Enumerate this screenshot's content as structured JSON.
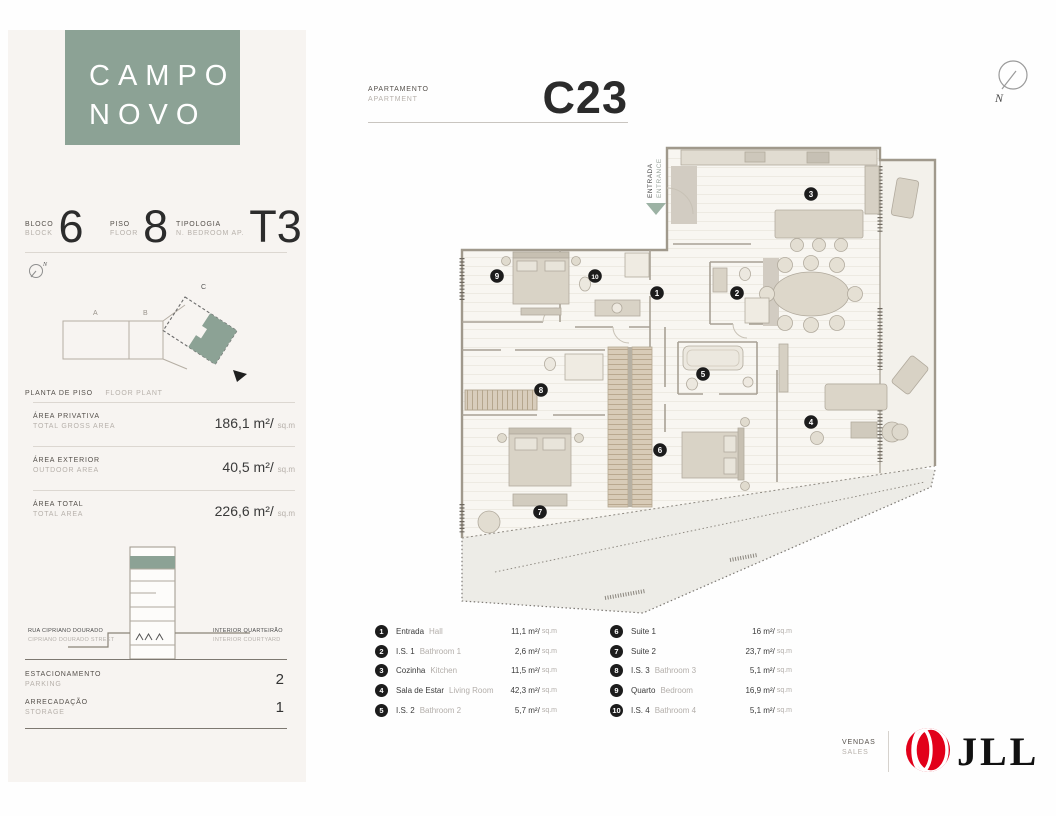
{
  "brand": {
    "name_line1": "CAMPO",
    "name_line2": "NOVO"
  },
  "header": {
    "label_pt": "APARTAMENTO",
    "label_en": "APARTMENT",
    "unit": "C23"
  },
  "compass": {
    "north_label": "N"
  },
  "sidebar": {
    "facts": [
      {
        "label_pt": "BLOCO",
        "label_en": "BLOCK",
        "value": "6"
      },
      {
        "label_pt": "PISO",
        "label_en": "FLOOR",
        "value": "8"
      },
      {
        "label_pt": "TIPOLOGIA",
        "label_en": "N. BEDROOM AP.",
        "value": "T3"
      }
    ],
    "site_plan": {
      "title_pt": "PLANTA DE PISO",
      "title_en": "FLOOR PLANT",
      "block_labels": [
        "A",
        "B",
        "C"
      ]
    },
    "areas": [
      {
        "label_pt": "ÁREA PRIVATIVA",
        "label_en": "TOTAL GROSS AREA",
        "value": "186,1 m²/",
        "unit": "sq.m"
      },
      {
        "label_pt": "ÁREA EXTERIOR",
        "label_en": "OUTDOOR AREA",
        "value": "40,5 m²/",
        "unit": "sq.m"
      },
      {
        "label_pt": "ÁREA TOTAL",
        "label_en": "TOTAL AREA",
        "value": "226,6 m²/",
        "unit": "sq.m"
      }
    ],
    "elevation": {
      "left_line1": "RUA CIPRIANO DOURADO",
      "left_line2": "CIPRIANO DOURADO STREET",
      "right_line1": "INTERIOR QUARTEIRÃO",
      "right_line2": "INTERIOR COURTYARD"
    },
    "amenities": [
      {
        "label_pt": "ESTACIONAMENTO",
        "label_en": "PARKING",
        "value": "2"
      },
      {
        "label_pt": "ARRECADAÇÃO",
        "label_en": "STORAGE",
        "value": "1"
      }
    ]
  },
  "plan": {
    "entrance_pt": "ENTRADA",
    "entrance_en": "ENTRANCE"
  },
  "legend": [
    {
      "num": "1",
      "name_pt": "Entrada",
      "name_en": "Hall",
      "value": "11,1 m²/",
      "unit": "sq.m"
    },
    {
      "num": "2",
      "name_pt": "I.S. 1",
      "name_en": "Bathroom 1",
      "value": "2,6 m²/",
      "unit": "sq.m"
    },
    {
      "num": "3",
      "name_pt": "Cozinha",
      "name_en": "Kitchen",
      "value": "11,5 m²/",
      "unit": "sq.m"
    },
    {
      "num": "4",
      "name_pt": "Sala de Estar",
      "name_en": "Living Room",
      "value": "42,3 m²/",
      "unit": "sq.m"
    },
    {
      "num": "5",
      "name_pt": "I.S. 2",
      "name_en": "Bathroom 2",
      "value": "5,7 m²/",
      "unit": "sq.m"
    },
    {
      "num": "6",
      "name_pt": "Suite 1",
      "name_en": "",
      "value": "16 m²/",
      "unit": "sq.m"
    },
    {
      "num": "7",
      "name_pt": "Suite 2",
      "name_en": "",
      "value": "23,7 m²/",
      "unit": "sq.m"
    },
    {
      "num": "8",
      "name_pt": "I.S. 3",
      "name_en": "Bathroom 3",
      "value": "5,1 m²/",
      "unit": "sq.m"
    },
    {
      "num": "9",
      "name_pt": "Quarto",
      "name_en": "Bedroom",
      "value": "16,9 m²/",
      "unit": "sq.m"
    },
    {
      "num": "10",
      "name_pt": "I.S. 4",
      "name_en": "Bathroom 4",
      "value": "5,1 m²/",
      "unit": "sq.m"
    }
  ],
  "footer": {
    "sales_pt": "VENDAS",
    "sales_en": "SALES",
    "agency": "JLL"
  },
  "colors": {
    "accent_green": "#8ca295",
    "jll_red": "#e2001a",
    "marker_black": "#1c1c1c"
  }
}
